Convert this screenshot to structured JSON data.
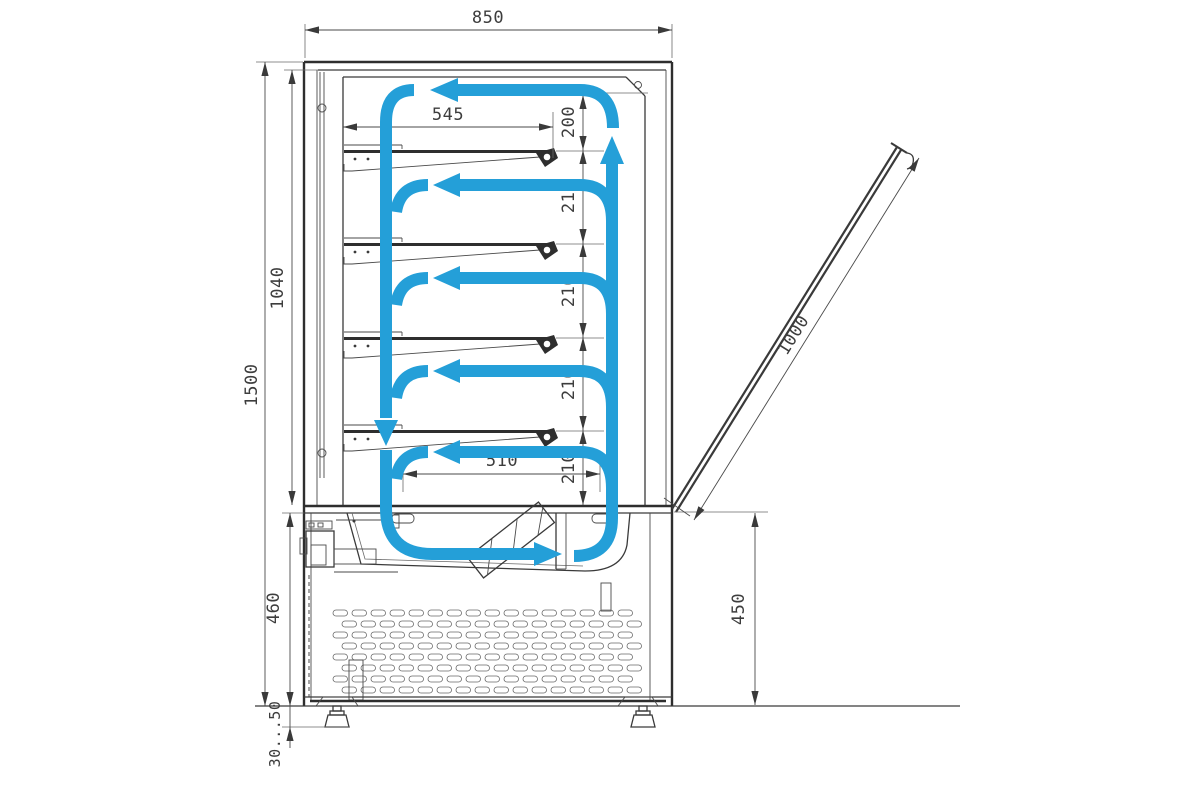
{
  "drawing": {
    "type": "technical-section-drawing",
    "subject": "refrigerated display case side section with air circulation"
  },
  "dimensions": {
    "overall_width": "850",
    "overall_height": "1500",
    "display_chamber_height": "1040",
    "base_height": "460",
    "adjustable_feet_range": "30...50",
    "shelf_depth": "545",
    "bottom_shelf_depth": "510",
    "top_clearance": "200",
    "shelf_gaps": [
      "210",
      "210",
      "210",
      "210"
    ],
    "rear_door_length": "1000",
    "base_rear_height": "450"
  },
  "colors": {
    "airflow": "#249FD8",
    "line": "#3a3a3a",
    "text": "#3d3d3d",
    "background": "#ffffff"
  }
}
